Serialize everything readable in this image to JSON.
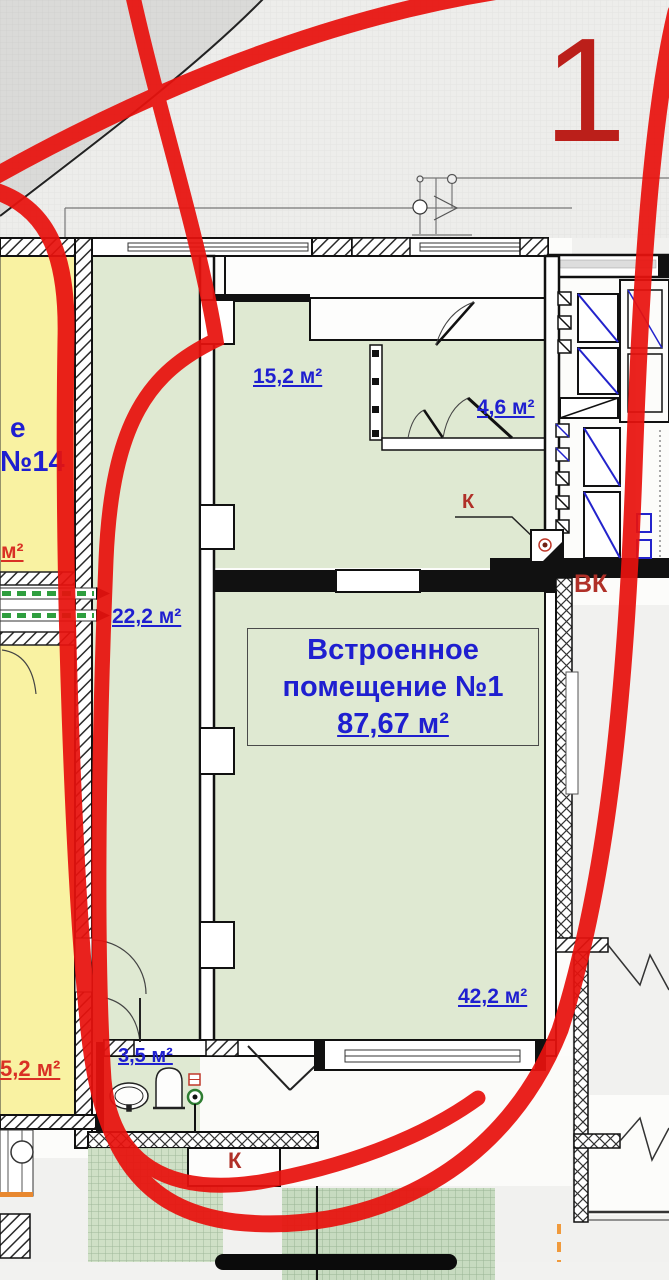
{
  "annotation": {
    "big_number": "1"
  },
  "premises": {
    "title_line1": "Встроенное",
    "title_line2": "помещение №1",
    "area": "87,67 м²"
  },
  "rooms": [
    {
      "name": "room-15-2",
      "area": "15,2 м²"
    },
    {
      "name": "room-4-6",
      "area": "4,6 м²"
    },
    {
      "name": "room-22-2",
      "area": "22,2 м²"
    },
    {
      "name": "room-42-2",
      "area": "42,2 м²"
    },
    {
      "name": "room-3-5",
      "area": "3,5 м²"
    }
  ],
  "neighbor": {
    "word_fragment": "е",
    "number": "№14",
    "area_fragment": "м²",
    "area_bottom": "5,2 м²"
  },
  "utilities": {
    "k_top": "К",
    "k_bottom": "К",
    "vk": "ВК"
  },
  "colors": {
    "marker_red": "#e8120e",
    "big_number_red": "#bb1f1a",
    "label_blue": "#1f1fd0",
    "label_red": "#d93025",
    "utility_red": "#b03028",
    "room_green": "#dfe9d2",
    "apartment_yellow": "#f9f2a2",
    "terrace_green": "#c7dbc0",
    "shaft_blue": "#2323cc",
    "axis_orange": "#f09a3c"
  },
  "icons": {
    "sink": "sink-icon",
    "toilet": "toilet-icon",
    "floor_drain": "floor-drain-icon",
    "stair_arrow": "direction-arrow-icon"
  }
}
